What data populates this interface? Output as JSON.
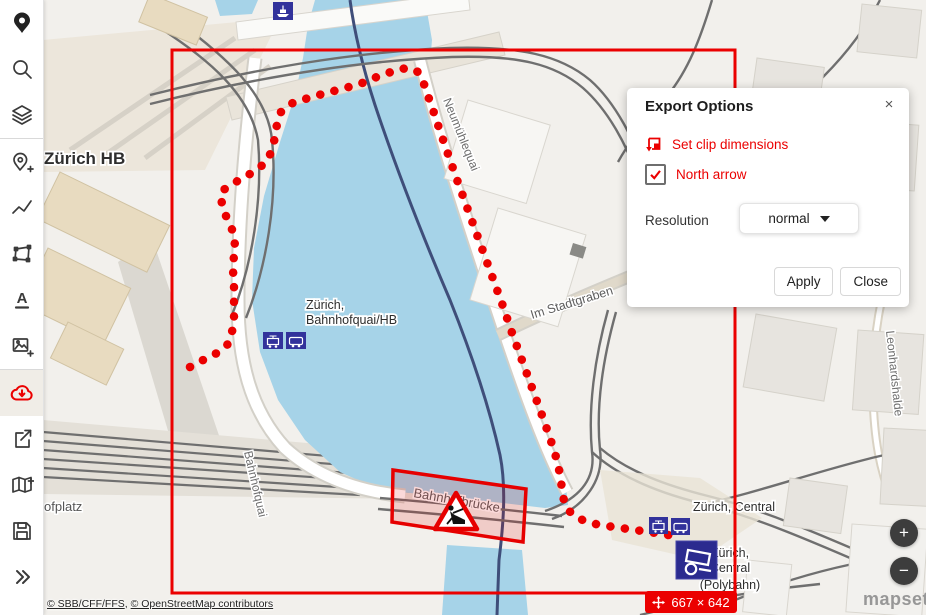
{
  "app": {
    "name": "mapset",
    "accent_color": "#eb0000",
    "stop_icon_color": "#32329b",
    "water_color": "#a6d3e8"
  },
  "sidebar": {
    "items": [
      {
        "icon": "mapset-logo"
      },
      {
        "icon": "search"
      },
      {
        "icon": "layers"
      },
      {
        "icon": "add-location"
      },
      {
        "icon": "draw-line"
      },
      {
        "icon": "draw-polygon"
      },
      {
        "icon": "add-text"
      },
      {
        "icon": "add-image"
      },
      {
        "icon": "export-download",
        "active": true
      },
      {
        "icon": "share"
      },
      {
        "icon": "add-map"
      },
      {
        "icon": "save"
      },
      {
        "icon": "expand-more"
      }
    ]
  },
  "export_panel": {
    "title": "Export Options",
    "close_icon": "×",
    "clip_label": "Set clip dimensions",
    "north_arrow_label": "North arrow",
    "north_arrow_checked": true,
    "resolution_label": "Resolution",
    "resolution_value": "normal",
    "apply_label": "Apply",
    "close_label": "Close"
  },
  "map": {
    "labels": {
      "zuerich_hb": "Zürich HB",
      "bahnhofquai_line1": "Zürich,",
      "bahnhofquai_line2": "Bahnhofquai/HB",
      "neumuehlequai": "Neumühlequai",
      "im_stadtgraben": "Im Stadtgraben",
      "bahnhofbruecke": "Bahnhofbrücke",
      "central": "Zürich, Central",
      "polybahn_line1": "Zürich,",
      "polybahn_line2": "Central",
      "polybahn_line3": "(Polybahn)",
      "leonhardshalde": "Leonhardshalde",
      "bahnhofquai_street": "Bahnhofquai",
      "bahnhofplatz": "ofplatz"
    },
    "badge": {
      "size": "667 × 642"
    },
    "attribution": {
      "sbb": "© SBB/CFF/FFS",
      "sep": ", ",
      "osm": "© OpenStreetMap contributors"
    },
    "watermark": "mapset"
  },
  "zoom_controls": {
    "zoom_in": "+",
    "zoom_out": "−"
  }
}
